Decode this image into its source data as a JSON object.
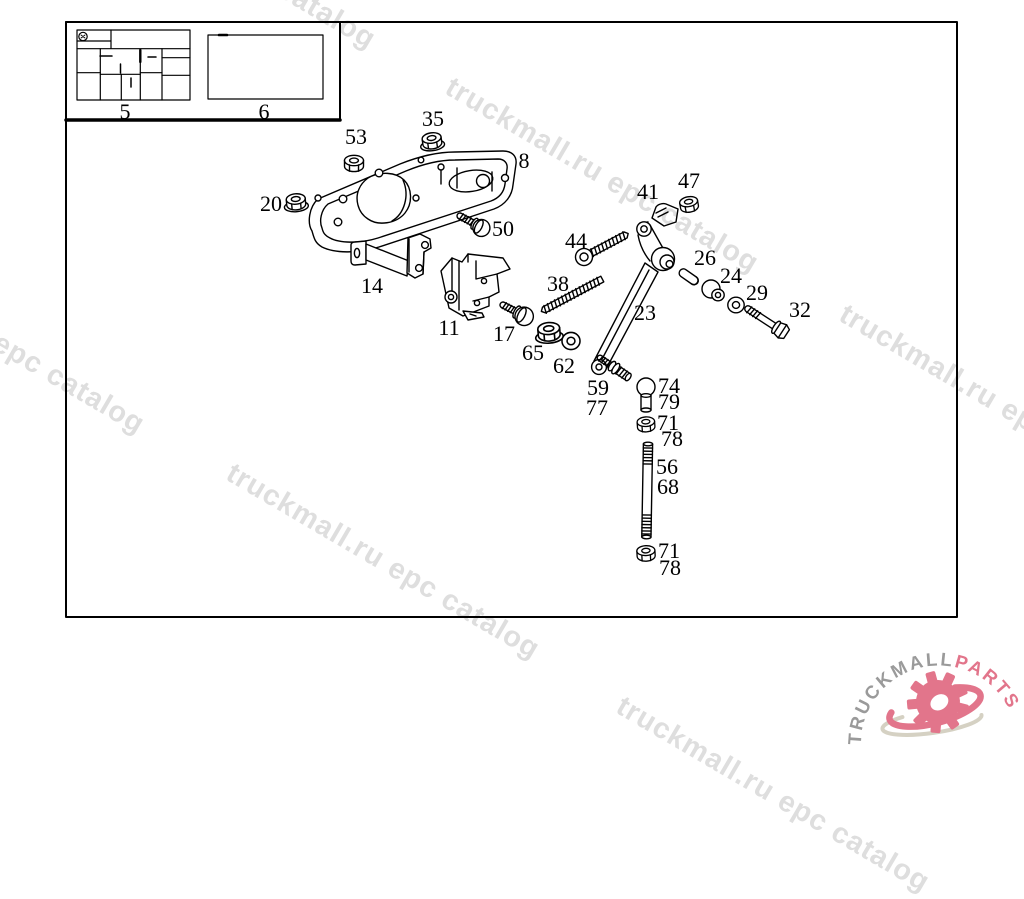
{
  "watermark": {
    "text": "truckmall.ru epc catalog",
    "color": "#dedede"
  },
  "logo": {
    "brand_gray": "TRUCKMALL",
    "brand_pink": "PARTS",
    "gray_color": "#9a9a9a",
    "pink_color": "#e2758b",
    "swoosh_color": "#d5d1c3"
  },
  "art_color": "#000000",
  "callouts": [
    {
      "label": "5"
    },
    {
      "label": "6"
    },
    {
      "label": "53"
    },
    {
      "label": "35"
    },
    {
      "label": "8"
    },
    {
      "label": "20"
    },
    {
      "label": "50"
    },
    {
      "label": "44"
    },
    {
      "label": "41"
    },
    {
      "label": "47"
    },
    {
      "label": "14"
    },
    {
      "label": "26"
    },
    {
      "label": "24"
    },
    {
      "label": "29"
    },
    {
      "label": "32"
    },
    {
      "label": "38"
    },
    {
      "label": "23"
    },
    {
      "label": "11"
    },
    {
      "label": "17"
    },
    {
      "label": "65"
    },
    {
      "label": "62"
    },
    {
      "label": "59"
    },
    {
      "label": "77"
    },
    {
      "label": "74"
    },
    {
      "label": "79"
    },
    {
      "label": "71"
    },
    {
      "label": "78"
    },
    {
      "label": "56"
    },
    {
      "label": "68"
    },
    {
      "label": "71"
    },
    {
      "label": "78"
    }
  ]
}
